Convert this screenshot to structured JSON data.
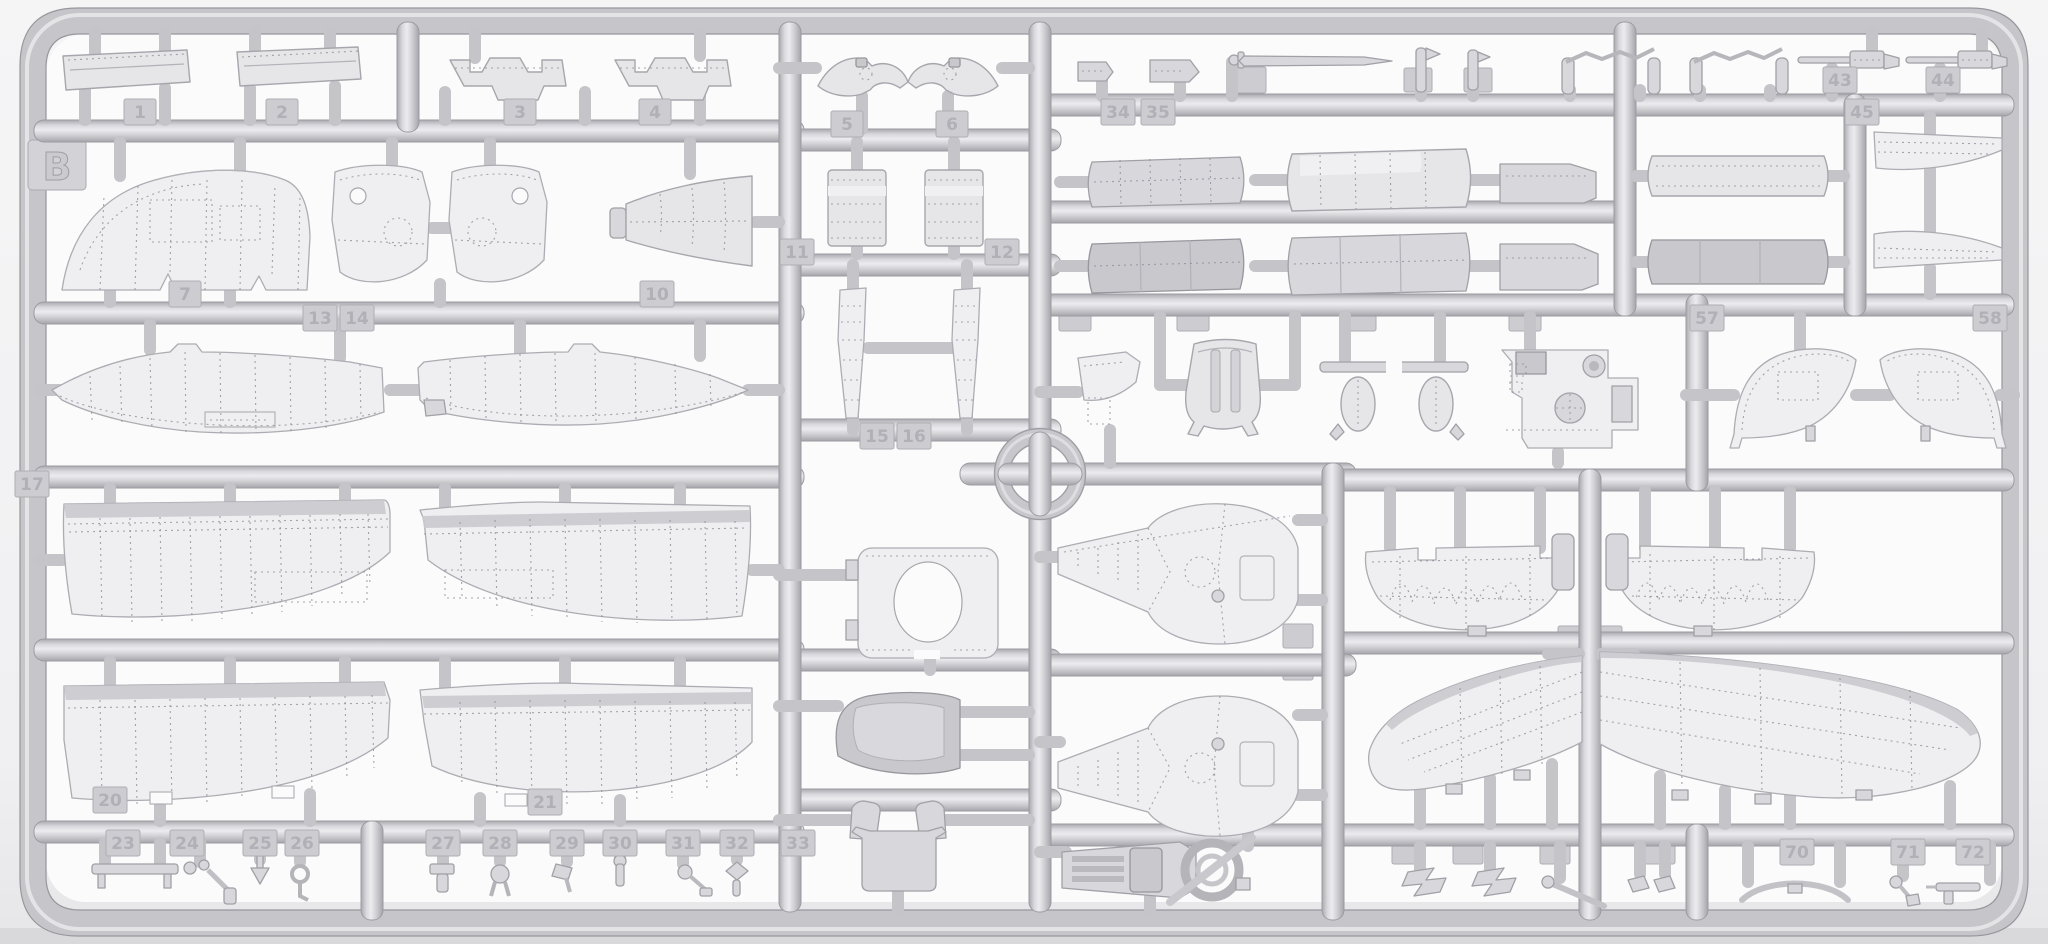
{
  "scene": {
    "description": "Photograph of a light-grey injection-moulded plastic model kit sprue (runner frame) containing aircraft parts: wings, fuselage halves, cowling segments, cockpit parts, guns and small fittings",
    "sprue_letter": "B",
    "plastic_color": "#d9d9dc",
    "background_color": "#f2f2f4",
    "registration_mark": "circle-with-cross"
  },
  "part_tags": [
    {
      "label": "1"
    },
    {
      "label": "2"
    },
    {
      "label": "3"
    },
    {
      "label": "4"
    },
    {
      "label": "5"
    },
    {
      "label": "6"
    },
    {
      "label": "7"
    },
    {
      "label": "10"
    },
    {
      "label": "11"
    },
    {
      "label": "12"
    },
    {
      "label": "13"
    },
    {
      "label": "14"
    },
    {
      "label": "15"
    },
    {
      "label": "16"
    },
    {
      "label": "17"
    },
    {
      "label": "20"
    },
    {
      "label": "21"
    },
    {
      "label": "23"
    },
    {
      "label": "24"
    },
    {
      "label": "25"
    },
    {
      "label": "26"
    },
    {
      "label": "27"
    },
    {
      "label": "28"
    },
    {
      "label": "29"
    },
    {
      "label": "30"
    },
    {
      "label": "31"
    },
    {
      "label": "32"
    },
    {
      "label": "33"
    },
    {
      "label": "34"
    },
    {
      "label": "35"
    },
    {
      "label": "43"
    },
    {
      "label": "44"
    },
    {
      "label": "45"
    },
    {
      "label": "57"
    },
    {
      "label": "58"
    },
    {
      "label": "70"
    },
    {
      "label": "71"
    },
    {
      "label": "72"
    }
  ]
}
